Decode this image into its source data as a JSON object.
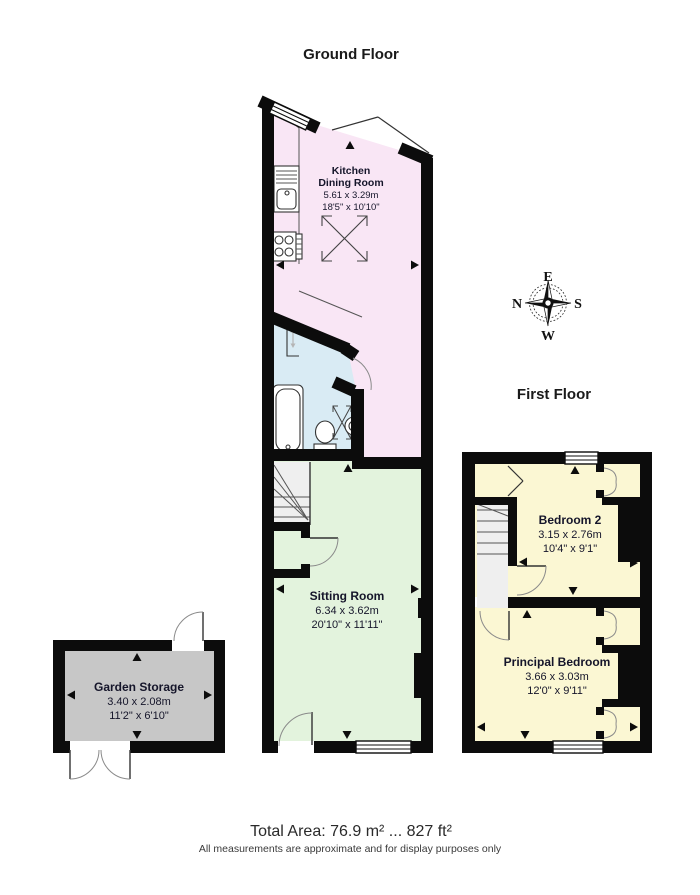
{
  "titles": {
    "ground": "Ground Floor",
    "first": "First Floor"
  },
  "rooms": {
    "kitchen": {
      "line1": "Kitchen",
      "line2": "Dining Room",
      "metric": "5.61 x 3.29m",
      "imperial": "18'5\" x 10'10\""
    },
    "sitting": {
      "name": "Sitting Room",
      "metric": "6.34 x 3.62m",
      "imperial": "20'10\" x 11'11\""
    },
    "bedroom2": {
      "name": "Bedroom 2",
      "metric": "3.15 x 2.76m",
      "imperial": "10'4\" x 9'1\""
    },
    "principal": {
      "name": "Principal Bedroom",
      "metric": "3.66 x 3.03m",
      "imperial": "12'0\" x 9'11\""
    },
    "storage": {
      "name": "Garden Storage",
      "metric": "3.40 x 2.08m",
      "imperial": "11'2\" x 6'10\""
    }
  },
  "compass": {
    "n": "N",
    "e": "E",
    "s": "S",
    "w": "W"
  },
  "footer": {
    "total_area": "Total Area: 76.9 m² ... 827 ft²",
    "disclaimer": "All measurements are approximate and for display purposes only"
  },
  "colors": {
    "kitchen": "#f9e6f5",
    "bathroom": "#d9ebf4",
    "sitting": "#e3f3dd",
    "bedroom": "#fbf7d3",
    "storage": "#c7c7c7",
    "stairs": "#efefef",
    "wall": "#0c0c0c"
  }
}
